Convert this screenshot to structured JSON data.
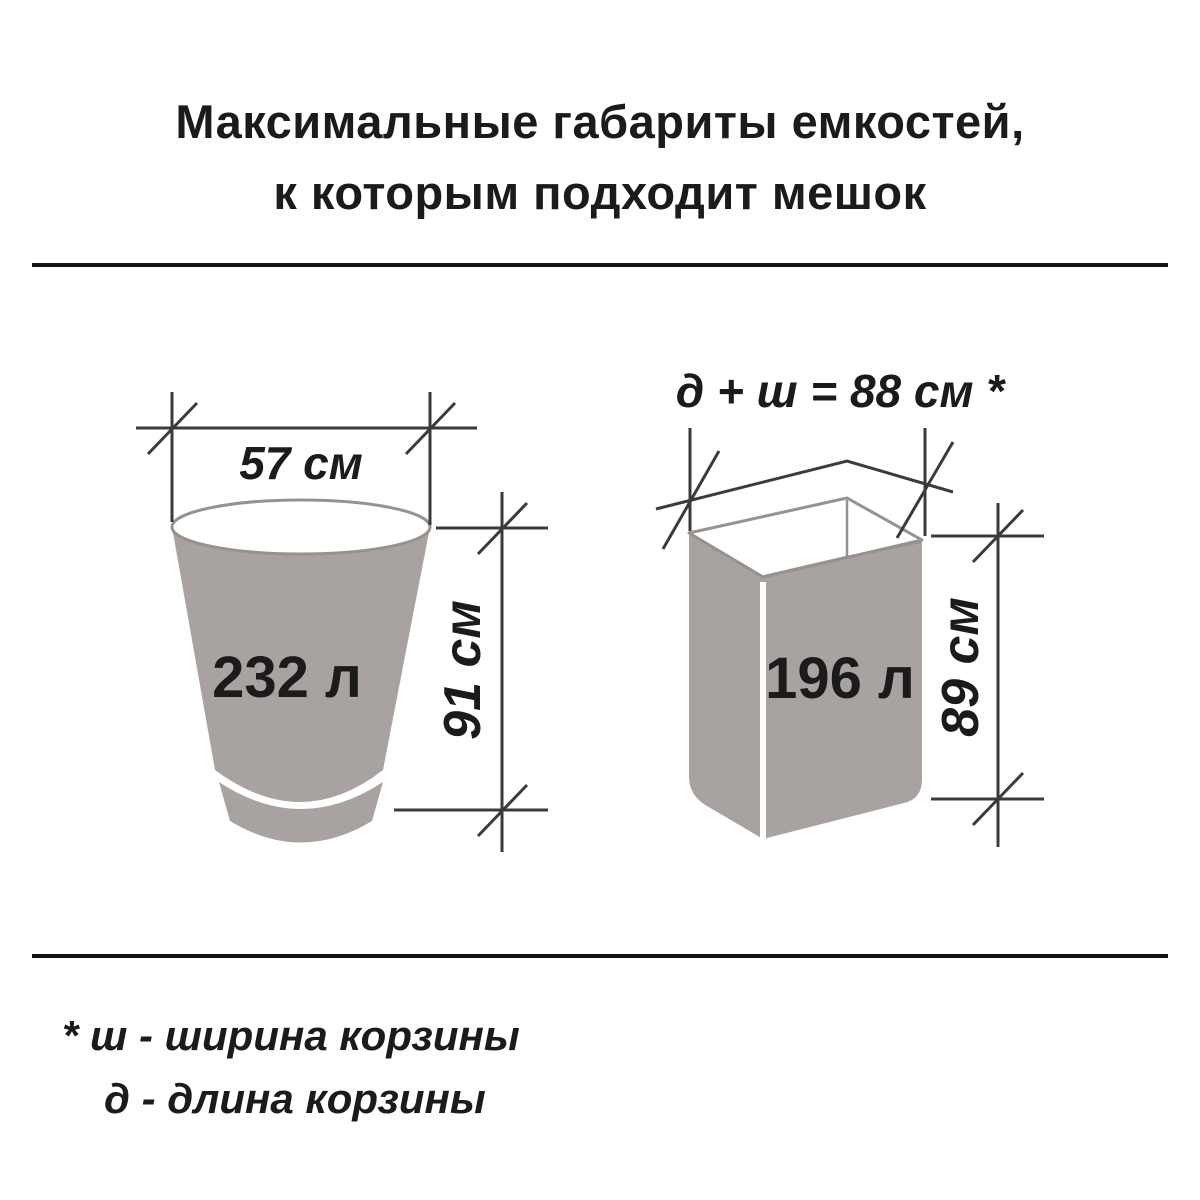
{
  "title": {
    "line1": "Максимальные габариты емкостей,",
    "line2": "к которым подходит мешок"
  },
  "bucket": {
    "volume_label": "232 л",
    "width_label": "57 см",
    "height_label": "91 см"
  },
  "basket": {
    "volume_label": "196 л",
    "perimeter_label": "д + ш = 88 см *",
    "height_label": "89 см"
  },
  "footnote": {
    "line1": "* ш - ширина корзины",
    "line2": "д - длина корзины"
  },
  "colors": {
    "container_fill": "#a8a3a1",
    "container_outline": "#97928e",
    "dimension_line": "#3b3b3b",
    "text": "#1b1b1b"
  }
}
